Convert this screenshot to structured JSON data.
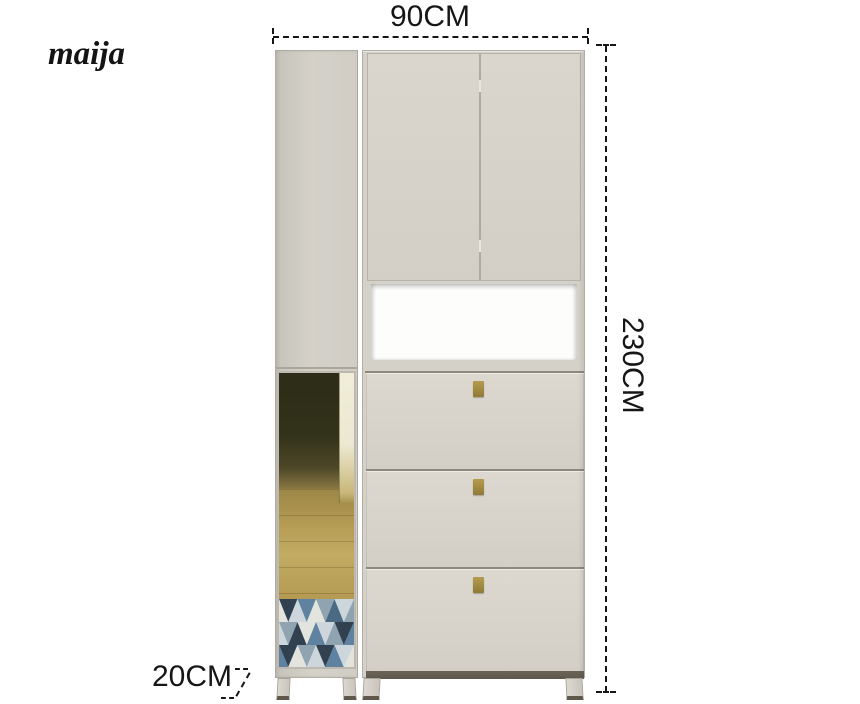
{
  "brand_logo": "maija",
  "annotations": {
    "width": "90CM",
    "height": "230CM",
    "depth": "20CM"
  },
  "colors": {
    "background": "#ffffff",
    "dimension_ink": "#161616",
    "cabinet_body": "#d4d1c9",
    "cabinet_body_dark": "#c6c3ba",
    "cabinet_edge": "#aaa69c",
    "door_face": "#dad6ce",
    "drawer_face": "#dcd8d0",
    "seam": "#8d887c",
    "niche_interior": "#fdfdfc",
    "base_rail": "#5e574c",
    "leg_foot": "#5f584a",
    "handle_gold_light": "#b59b4d",
    "handle_gold_dark": "#8f7a38",
    "mirror_room_dark": "#33331b",
    "mirror_floor_wood": "#b79d55",
    "mirror_door_strip": "#ece8d2",
    "rug_navy": "#31414f",
    "rug_blue": "#5f82a0",
    "rug_steel": "#8fa3b1",
    "rug_light": "#ccd6dc",
    "rug_pale": "#e4e4de"
  }
}
